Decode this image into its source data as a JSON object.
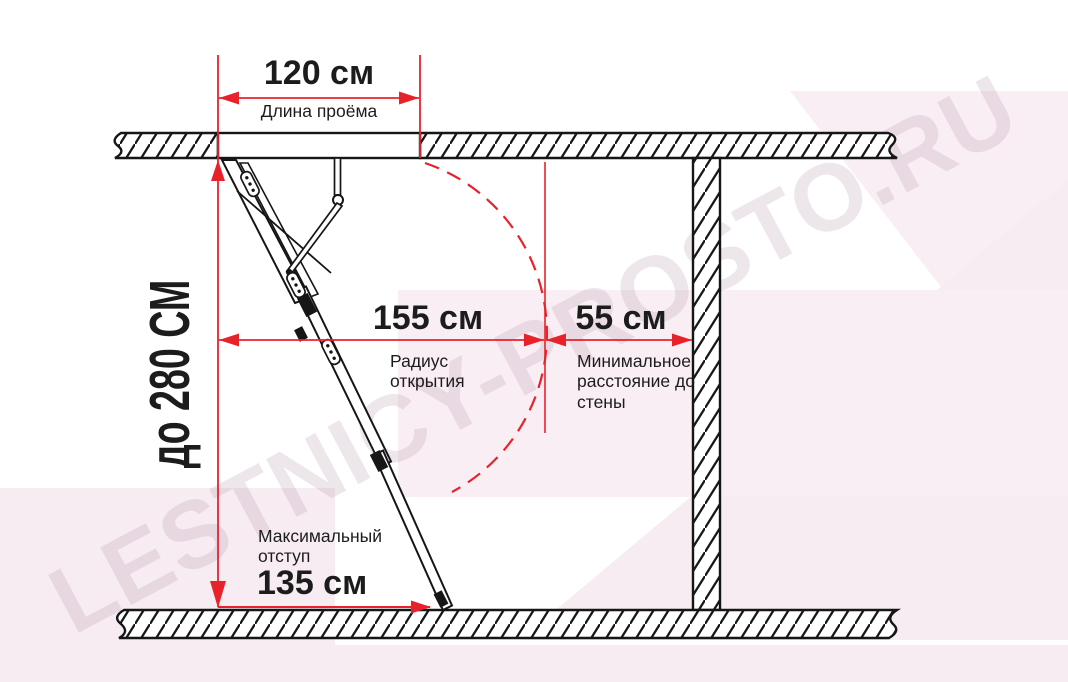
{
  "watermark": {
    "text": "LESTNICY-PROSTO.RU"
  },
  "colors": {
    "accent_red": "#e8222b",
    "ink": "#161616",
    "pink_light": "#f7ecf2",
    "pink_lighter": "#f9eef4"
  },
  "dims": {
    "opening": {
      "value": "120 см",
      "label": "Длина проёма"
    },
    "ceiling_height": {
      "value": "до 280 СМ"
    },
    "radius": {
      "value": "155 см",
      "label": "Радиус открытия"
    },
    "wall_clearance": {
      "value": "55 см",
      "label": "Минимальное расстояние до стены"
    },
    "offset": {
      "value": "135 см",
      "label": "Максимальный отступ"
    }
  }
}
